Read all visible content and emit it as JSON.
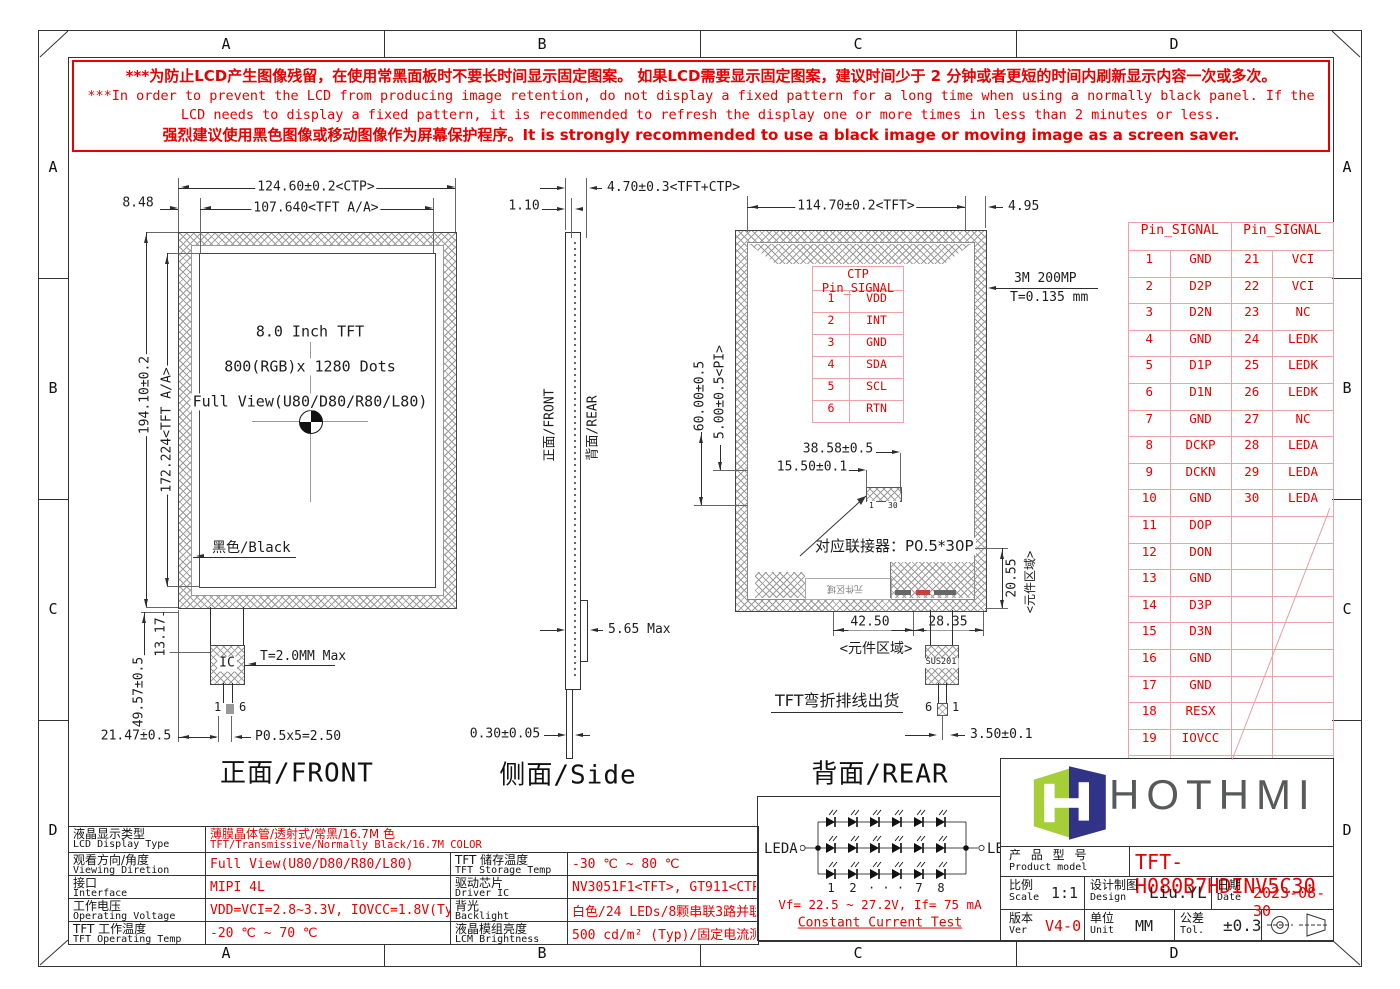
{
  "sheet": {
    "zones": [
      "A",
      "B",
      "C",
      "D"
    ]
  },
  "warning": {
    "lines": [
      "***为防止LCD产生图像残留，在使用常黑面板时不要长时间显示固定图案。 如果LCD需要显示固定图案，建议时间少于 2 分钟或者更短的时间内刷新显示内容一次或多次。",
      "***In order to prevent the LCD from producing image retention, do not display a fixed pattern for a long time when using a normally black panel. If the",
      "LCD needs to display a fixed pattern, it is recommended to refresh the display one or more times in less than 2 minutes or less.",
      "强烈建议使用黑色图像或移动图像作为屏幕保护程序。It is strongly recommended to use a black image or moving image as a screen saver."
    ]
  },
  "front": {
    "title": "正面/FRONT",
    "panel_lines": [
      "8.0 Inch TFT",
      "800(RGB)x 1280 Dots",
      "Full View(U80/D80/R80/L80)"
    ],
    "black_label": "黑色/Black",
    "ic_label": "IC",
    "fpc_pin_first": "1",
    "fpc_pin_last": "6",
    "dims": {
      "ctp_width": "124.60±0.2<CTP>",
      "aa_width": "107.640<TFT A/A>",
      "left_margin": "8.48",
      "height": "194.10±0.2",
      "aa_height": "172.224<TFT A/A>",
      "bottom_height": "49.57±0.5",
      "bottom_lip": "13.17",
      "fpc_offset": "21.47±0.5",
      "pitch": "P0.5x5=2.50",
      "ic_thickness": "T=2.0MM Max"
    }
  },
  "side": {
    "title": "侧面/Side",
    "front_label": "正面/FRONT",
    "rear_label": "背面/REAR",
    "dims": {
      "total_thickness": "4.70±0.3<TFT+CTP>",
      "glass": "1.10",
      "max_thickness": "5.65 Max",
      "fpc_thickness": "0.30±0.05"
    }
  },
  "rear": {
    "title": "背面/REAR",
    "connector_note": "对应联接器：P0.5*30P",
    "connector_pin_first": "1",
    "connector_pin_last": "30",
    "component_area_bottom": "<元件区域>",
    "component_area_side": "<元件区域>",
    "component_area_inner": "元件区域",
    "fpc_note": "TFT弯折排线出货",
    "sus_label": "SUS201",
    "fpc_pin_first": "6",
    "fpc_pin_last": "1",
    "dims": {
      "tft_width": "114.70±0.2<TFT>",
      "right_margin": "4.95",
      "tape": "3M 200MP",
      "tape_thickness": "T=0.135 mm",
      "conn_offset_y": "60.00±0.5",
      "pi": "5.00±0.5<PI>",
      "conn_x": "38.58±0.5",
      "conn_x2": "15.50±0.1",
      "comp_left": "42.50",
      "comp_right": "28.35",
      "comp_height": "20.55",
      "fpc_width": "3.50±0.1"
    },
    "ctp_table": {
      "header": "CTP Pin_SIGNAL",
      "rows": [
        [
          "1",
          "VDD"
        ],
        [
          "2",
          "INT"
        ],
        [
          "3",
          "GND"
        ],
        [
          "4",
          "SDA"
        ],
        [
          "5",
          "SCL"
        ],
        [
          "6",
          "RTN"
        ]
      ]
    }
  },
  "pin_table": {
    "headers": [
      "Pin_SIGNAL",
      "Pin_SIGNAL"
    ],
    "rows": [
      [
        "1",
        "GND",
        "21",
        "VCI"
      ],
      [
        "2",
        "D2P",
        "22",
        "VCI"
      ],
      [
        "3",
        "D2N",
        "23",
        "NC"
      ],
      [
        "4",
        "GND",
        "24",
        "LEDK"
      ],
      [
        "5",
        "D1P",
        "25",
        "LEDK"
      ],
      [
        "6",
        "D1N",
        "26",
        "LEDK"
      ],
      [
        "7",
        "GND",
        "27",
        "NC"
      ],
      [
        "8",
        "DCKP",
        "28",
        "LEDA"
      ],
      [
        "9",
        "DCKN",
        "29",
        "LEDA"
      ],
      [
        "10",
        "GND",
        "30",
        "LEDA"
      ],
      [
        "11",
        "DOP",
        "",
        ""
      ],
      [
        "12",
        "DON",
        "",
        ""
      ],
      [
        "13",
        "GND",
        "",
        ""
      ],
      [
        "14",
        "D3P",
        "",
        ""
      ],
      [
        "15",
        "D3N",
        "",
        ""
      ],
      [
        "16",
        "GND",
        "",
        ""
      ],
      [
        "17",
        "GND",
        "",
        ""
      ],
      [
        "18",
        "RESX",
        "",
        ""
      ],
      [
        "19",
        "IOVCC",
        "",
        ""
      ],
      [
        "20",
        "NC",
        "",
        ""
      ]
    ]
  },
  "spec_table": {
    "rows": [
      {
        "l1cn": "液晶显示类型",
        "l1en": "LCD Display Type",
        "v1cn": "薄膜晶体管/透射式/常黑/16.7M 色",
        "v1en": "TFT/Transmissive/Normally Black/16.7M COLOR"
      },
      {
        "l1cn": "观看方向/角度",
        "l1en": "Viewing Diretion",
        "v1": "Full View(U80/D80/R80/L80)",
        "l2cn": "TFT 储存温度",
        "l2en": "TFT Storage Temp",
        "v2": "-30 ℃ ~ 80 ℃"
      },
      {
        "l1cn": "接口",
        "l1en": "Interface",
        "v1": "MIPI 4L",
        "l2cn": "驱动芯片",
        "l2en": "Driver IC",
        "v2": "NV3051F1<TFT>, GT911<CTP>"
      },
      {
        "l1cn": "工作电压",
        "l1en": "Operating Voltage",
        "v1": "VDD=VCI=2.8~3.3V, IOVCC=1.8V(Typ)",
        "l2cn": "背光",
        "l2en": "Backlight",
        "v2": "白色/24 LEDs/8颗串联3路并联"
      },
      {
        "l1cn": "TFT 工作温度",
        "l1en": "TFT Operating Temp",
        "v1": "-20 ℃ ~ 70 ℃",
        "l2cn": "液晶模组亮度",
        "l2en": "LCM Brightness",
        "v2": "500 cd/m² (Typ)/固定电流测试"
      }
    ]
  },
  "led": {
    "anode": "LEDA",
    "cathode": "LEDK",
    "indices": [
      "1",
      "2",
      "· · ·",
      "7",
      "8"
    ],
    "vf": "Vf= 22.5 ~ 27.2V, If= 75 mA",
    "test": "Constant Current Test"
  },
  "titleblock": {
    "brand": "HOTHMI",
    "product_label_cn": "产 品 型 号",
    "product_label_en": "Product model",
    "model": "TFT-H080B7HDINV5C30",
    "scale_cn": "比例",
    "scale_en": "Scale",
    "scale": "1:1",
    "design_cn": "设计制图",
    "design_en": "Design",
    "designer": "Liu.YL",
    "date_cn": "日期",
    "date_en": "Date",
    "date": "2023-08-30",
    "ver_cn": "版本",
    "ver_en": "Ver",
    "ver": "V4-0",
    "unit_cn": "单位",
    "unit_en": "Unit",
    "unit": "MM",
    "tol_cn": "公差",
    "tol_en": "Tol.",
    "tol": "±0.3"
  },
  "colors": {
    "red": "#e60000",
    "table_border": "#f0a3a3",
    "brand_green": "#a6ce39",
    "brand_navy": "#303386",
    "brand_gray": "#58595b"
  }
}
